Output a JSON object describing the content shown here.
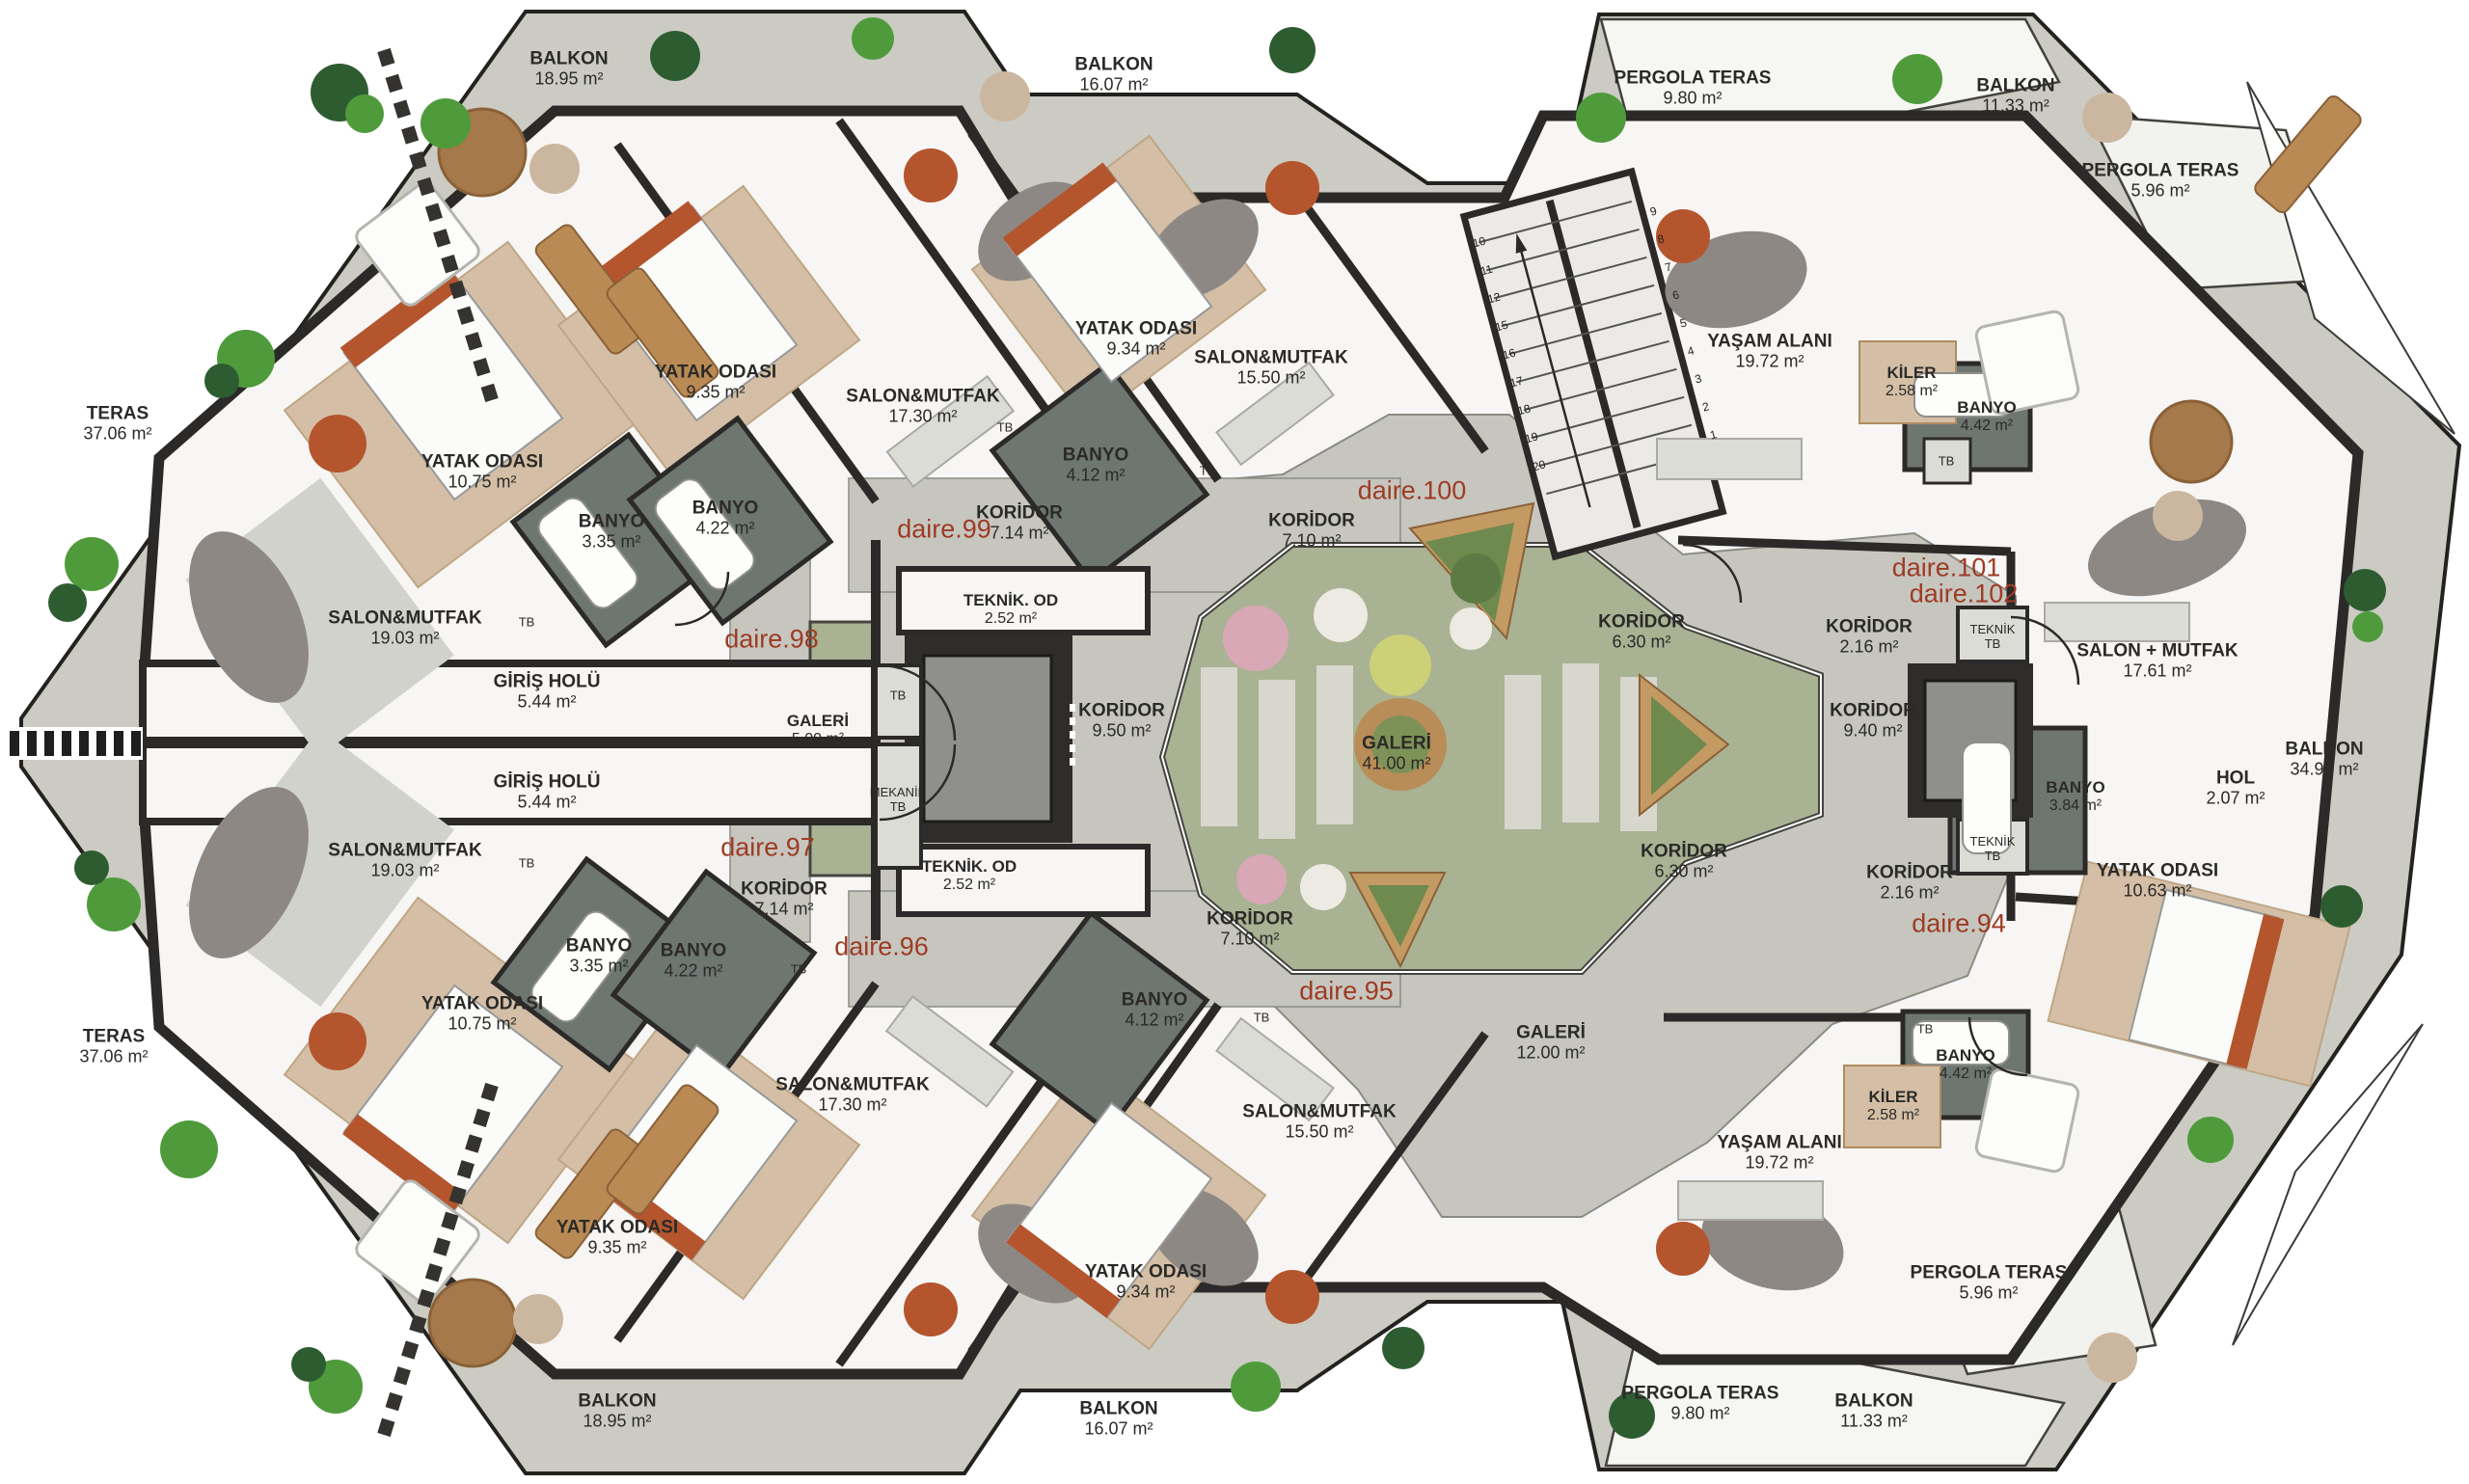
{
  "colors": {
    "wall": "#2c2a28",
    "terrace": "#cbcbc3",
    "corridor": "#c6c6bf",
    "floor": "#f7f6f4",
    "garden_green": "#a9b293",
    "planter_wood": "#c49a63",
    "wood_floor": "#d4bfa6",
    "bath": "#6e7672",
    "unit_label": "#9e3b24",
    "label": "#2b2a28"
  },
  "plan": {
    "areas": {
      "balkon_tl": {
        "name": "BALKON",
        "area": "18.95 m²"
      },
      "balkon_tc": {
        "name": "BALKON",
        "area": "16.07 m²"
      },
      "pergola_tr": {
        "name": "PERGOLA TERAS",
        "area": "9.80 m²"
      },
      "balkon_tr": {
        "name": "BALKON",
        "area": "11.33 m²"
      },
      "pergola_r_top": {
        "name": "PERGOLA TERAS",
        "area": "5.96 m²"
      },
      "teras_top": {
        "name": "TERAS",
        "area": "37.06 m²"
      },
      "yatak_d98": {
        "name": "YATAK ODASI",
        "area": "10.75 m²"
      },
      "yatak_d99": {
        "name": "YATAK ODASI",
        "area": "9.35 m²"
      },
      "salon_d99": {
        "name": "SALON&MUTFAK",
        "area": "17.30 m²"
      },
      "yatak_d100": {
        "name": "YATAK ODASI",
        "area": "9.34 m²"
      },
      "salon_d100": {
        "name": "SALON&MUTFAK",
        "area": "15.50 m²"
      },
      "banyo_335_t": {
        "name": "BANYO",
        "area": "3.35 m²"
      },
      "banyo_422_t": {
        "name": "BANYO",
        "area": "4.22 m²"
      },
      "banyo_412_t": {
        "name": "BANYO",
        "area": "4.12 m²"
      },
      "salon_d98": {
        "name": "SALON&MUTFAK",
        "area": "19.03 m²"
      },
      "giris_1": {
        "name": "GİRİŞ HOLÜ",
        "area": "5.44 m²"
      },
      "giris_2": {
        "name": "GİRİŞ HOLÜ",
        "area": "5.44 m²"
      },
      "koridor_714_t": {
        "name": "KORİDOR",
        "area": "7.14 m²"
      },
      "teknik_od_t": {
        "name": "TEKNİK. OD",
        "area": "2.52 m²"
      },
      "galeri_5": {
        "name": "GALERİ",
        "area": "5.00 m²"
      },
      "koridor_950": {
        "name": "KORİDOR",
        "area": "9.50 m²"
      },
      "teknik_od_b": {
        "name": "TEKNİK. OD",
        "area": "2.52 m²"
      },
      "koridor_710_t": {
        "name": "KORİDOR",
        "area": "7.10 m²"
      },
      "galeri_41": {
        "name": "GALERİ",
        "area": "41.00 m²"
      },
      "yasam_t": {
        "name": "YAŞAM ALANI",
        "area": "19.72 m²"
      },
      "kiler_t": {
        "name": "KİLER",
        "area": "2.58 m²"
      },
      "banyo_442_t": {
        "name": "BANYO",
        "area": "4.42 m²"
      },
      "koridor_630_t": {
        "name": "KORİDOR",
        "area": "6.30 m²"
      },
      "koridor_216_t": {
        "name": "KORİDOR",
        "area": "2.16 m²"
      },
      "salon_1761": {
        "name": "SALON + MUTFAK",
        "area": "17.61 m²"
      },
      "koridor_940": {
        "name": "KORİDOR",
        "area": "9.40 m²"
      },
      "balkon_3492": {
        "name": "BALKON",
        "area": "34.92 m²"
      },
      "banyo_384": {
        "name": "BANYO",
        "area": "3.84 m²"
      },
      "hol_207": {
        "name": "HOL",
        "area": "2.07 m²"
      },
      "koridor_216_b": {
        "name": "KORİDOR",
        "area": "2.16 m²"
      },
      "yatak_1063": {
        "name": "YATAK ODASI",
        "area": "10.63 m²"
      },
      "koridor_630_b": {
        "name": "KORİDOR",
        "area": "6.30 m²"
      },
      "galeri_12": {
        "name": "GALERİ",
        "area": "12.00 m²"
      },
      "koridor_710_b": {
        "name": "KORİDOR",
        "area": "7.10 m²"
      },
      "banyo_412_b": {
        "name": "BANYO",
        "area": "4.12 m²"
      },
      "salon_1550_b": {
        "name": "SALON&MUTFAK",
        "area": "15.50 m²"
      },
      "yatak_934_b": {
        "name": "YATAK ODASI",
        "area": "9.34 m²"
      },
      "koridor_714_b": {
        "name": "KORİDOR",
        "area": "7.14 m²"
      },
      "banyo_335_b": {
        "name": "BANYO",
        "area": "3.35 m²"
      },
      "banyo_422_b": {
        "name": "BANYO",
        "area": "4.22 m²"
      },
      "salon_1730_b": {
        "name": "SALON&MUTFAK",
        "area": "17.30 m²"
      },
      "yatak_935_b": {
        "name": "YATAK ODASI",
        "area": "9.35 m²"
      },
      "salon_1903_b": {
        "name": "SALON&MUTFAK",
        "area": "19.03 m²"
      },
      "yatak_1075_b": {
        "name": "YATAK ODASI",
        "area": "10.75 m²"
      },
      "teras_b": {
        "name": "TERAS",
        "area": "37.06 m²"
      },
      "balkon_bl": {
        "name": "BALKON",
        "area": "18.95 m²"
      },
      "balkon_bc": {
        "name": "BALKON",
        "area": "16.07 m²"
      },
      "yasam_b": {
        "name": "YAŞAM ALANI",
        "area": "19.72 m²"
      },
      "kiler_b": {
        "name": "KİLER",
        "area": "2.58 m²"
      },
      "banyo_442_b": {
        "name": "BANYO",
        "area": "4.42 m²"
      },
      "pergola_r_bot": {
        "name": "PERGOLA TERAS",
        "area": "5.96 m²"
      },
      "balkon_br": {
        "name": "BALKON",
        "area": "11.33 m²"
      },
      "pergola_bb": {
        "name": "PERGOLA TERAS",
        "area": "9.80 m²"
      }
    },
    "units": {
      "d94": "daire.94",
      "d95": "daire.95",
      "d96": "daire.96",
      "d97": "daire.97",
      "d98": "daire.98",
      "d99": "daire.99",
      "d100": "daire.100",
      "d101": "daire.101",
      "d102": "daire.102"
    },
    "shafts": {
      "tb1": "TB",
      "tb2": "TB",
      "tb3": "TB",
      "tb4": "TB",
      "tb5": "TB",
      "tb6": "TB",
      "tb7": "TB",
      "tb8": "TB",
      "tb9": "TB",
      "mekanik_tb": "MEKANİK TB",
      "teknik_tb1": "TEKNİK TB",
      "teknik_tb2": "TEKNİK TB"
    },
    "stairs": {
      "left": [
        "10",
        "11",
        "12",
        "15",
        "16",
        "17",
        "18",
        "19",
        "20"
      ],
      "right": [
        "9",
        "8",
        "7",
        "6",
        "5",
        "4",
        "3",
        "2",
        "1"
      ]
    }
  }
}
